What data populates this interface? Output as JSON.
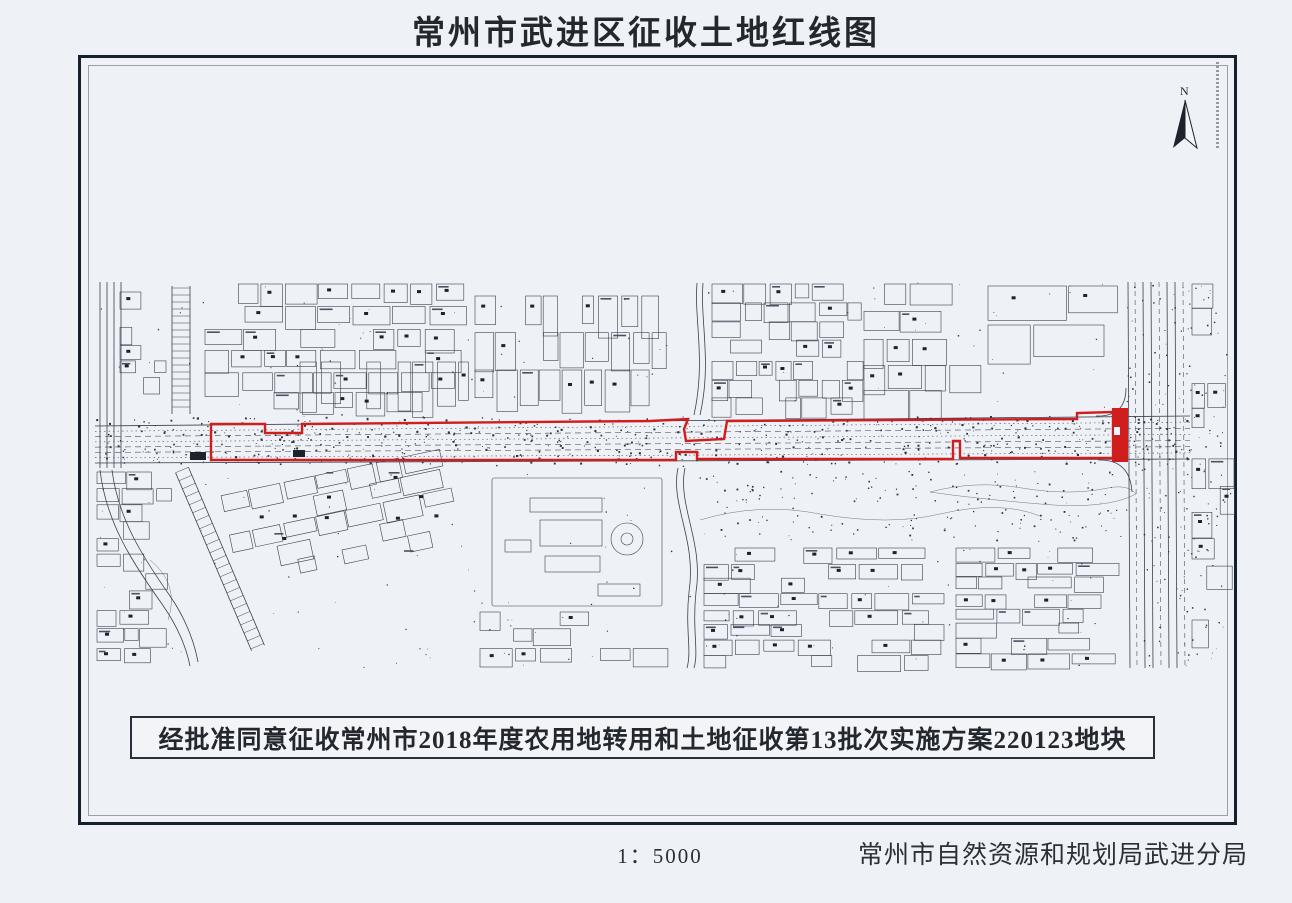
{
  "page": {
    "title": "常州市武进区征收土地红线图",
    "approval_note": "经批准同意征收常州市2018年度农用地转用和土地征收第13批次实施方案220123地块",
    "scale_label": "1：5000",
    "agency": "常州市自然资源和规划局武进分局",
    "north_label": "N"
  },
  "colors": {
    "paper": "#eef1f5",
    "ink": "#3a4150",
    "ink_dark": "#1d222c",
    "contour": "#707785",
    "frame_outer": "#16202e",
    "frame_inner": "#9aa1ad",
    "redline": "#d01d1d"
  },
  "map": {
    "redline": {
      "outline": [
        [
          211,
          424
        ],
        [
          265,
          424
        ],
        [
          265,
          433
        ],
        [
          302,
          433
        ],
        [
          302,
          424
        ],
        [
          650,
          421
        ],
        [
          688,
          419
        ],
        [
          684,
          429
        ],
        [
          686,
          441
        ],
        [
          724,
          439
        ],
        [
          727,
          421
        ],
        [
          1077,
          419
        ],
        [
          1077,
          413
        ],
        [
          1113,
          412
        ],
        [
          1113,
          458
        ],
        [
          960,
          458
        ],
        [
          960,
          441
        ],
        [
          953,
          441
        ],
        [
          953,
          459
        ],
        [
          697,
          459
        ],
        [
          697,
          452
        ],
        [
          676,
          452
        ],
        [
          676,
          460
        ],
        [
          211,
          460
        ]
      ],
      "bar": [
        1112,
        408,
        16,
        54
      ],
      "bar_notch": [
        1114,
        427,
        6,
        8
      ]
    }
  }
}
